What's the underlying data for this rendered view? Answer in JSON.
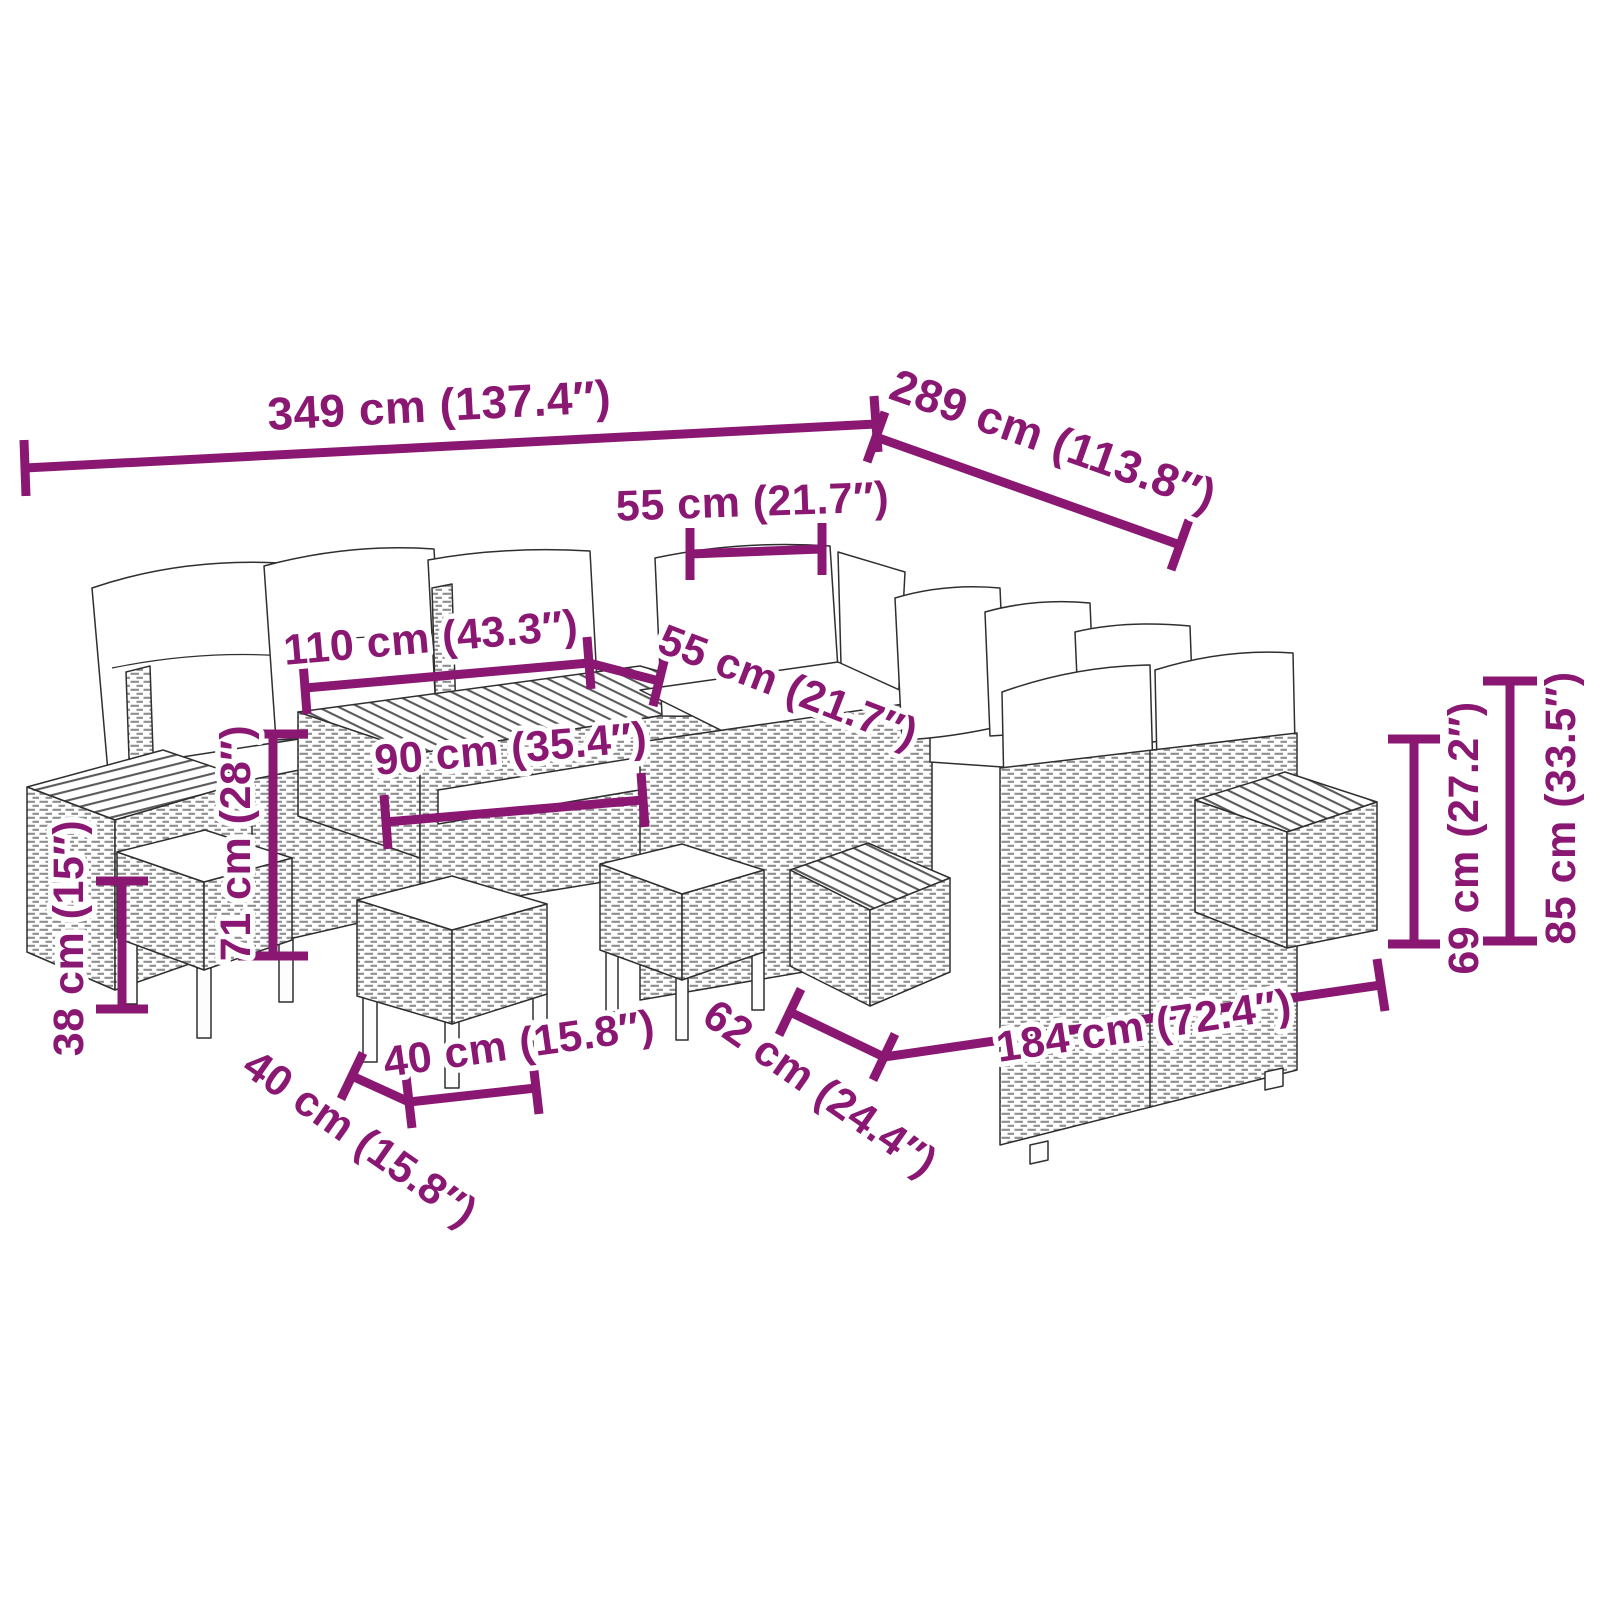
{
  "diagram": {
    "subject": "garden-lounge-set-dimension-diagram",
    "accent_color": "#8a1873",
    "line_color": "#2f2f2f",
    "dims": {
      "total_width": "349 cm (137.4″)",
      "total_depth": "289 cm (113.8″)",
      "seat_width": "55 cm (21.7″)",
      "seat_depth": "55 cm (21.7″)",
      "table_length": "110 cm (43.3″)",
      "table_width": "90 cm (35.4″)",
      "table_height": "71 cm (28″)",
      "stool_height": "38 cm (15″)",
      "stool_width": "40 cm (15.8″)",
      "stool_depth": "40 cm (15.8″)",
      "sofa_depth": "62 cm (24.4″)",
      "sofa_length": "184 cm (72.4″)",
      "seat_back_height": "69 cm (27.2″)",
      "total_height": "85 cm (33.5″)"
    }
  }
}
